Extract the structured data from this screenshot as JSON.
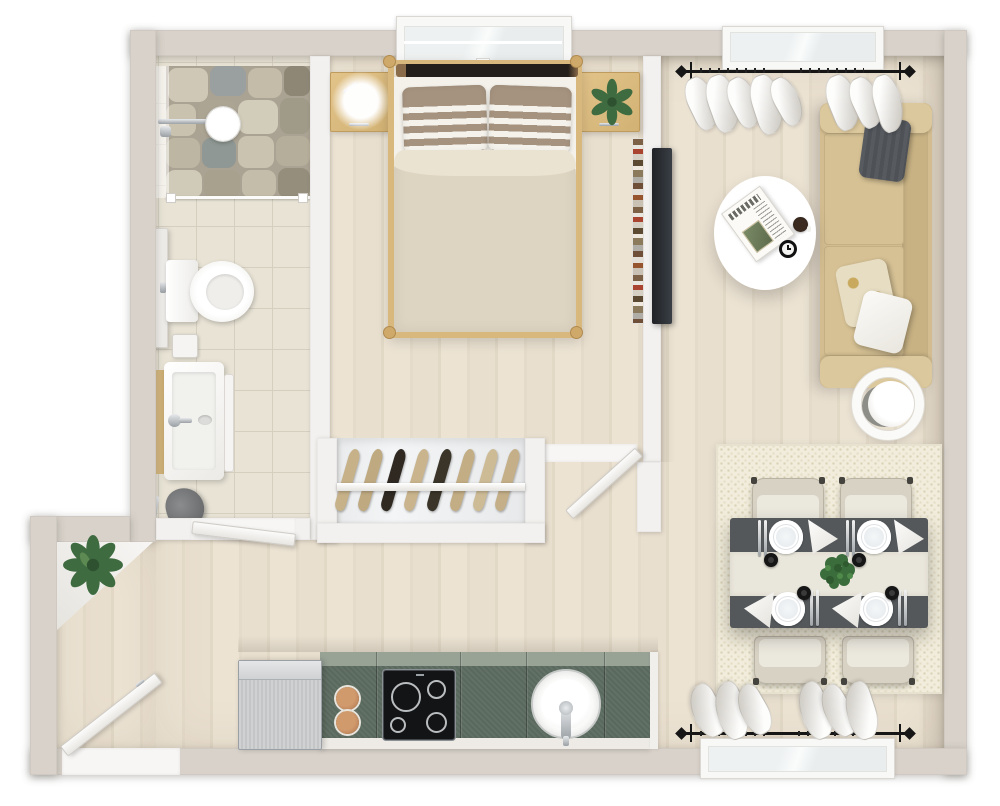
{
  "meta": {
    "scene": "3d-rendered-top-view-floor-plan-one-bedroom-apartment",
    "visible_text": "none"
  },
  "colors": {
    "wood": "#e9e0d0",
    "wall-ext": "#d8d2ca",
    "wall-int": "#f2f1ef",
    "tile": "#e8e3d5",
    "tile-line": "#d5cfc0",
    "counter-green": "#5a695e",
    "counter-back": "#98a295",
    "steel": "#c9cbcd",
    "table-dark": "#54585b",
    "runner": "#e9e6db",
    "sofa": "#d3bd90",
    "sofa-arm": "#dcc89d",
    "rug": "#f1ecdb",
    "rug-dot": "#d9d2b6",
    "duvet": "#ded4c2",
    "sheet": "#f4f1ea",
    "pillow-stripe": "#a5937f",
    "oak": "#dcbc80",
    "plant": "#3f6b40",
    "tv": "#2b2f34",
    "copper": "#c08b60",
    "chair": "#d8d2c4",
    "curtain-hi": "#fdfdfc",
    "curtain-lo": "#d5d2cc",
    "rod": "#161616"
  },
  "rooms": [
    {
      "name": "bathroom",
      "items": [
        "walk-in-shower",
        "stone-shower-floor",
        "rain-shower-head",
        "glass-partition",
        "tall-cabinet",
        "toilet",
        "flush-plate",
        "vanity-basin",
        "faucet",
        "towel-rail",
        "laundry-bag",
        "toilet-brush",
        "interior-door"
      ]
    },
    {
      "name": "bedroom",
      "items": [
        "window",
        "double-bed",
        "dark-headboard",
        "striped-pillow-x2",
        "duvet",
        "nightstand-x2",
        "glowing-table-lamp",
        "potted-plant",
        "wall-bookshelf",
        "open-closet",
        "hanging-garments-x8",
        "interior-door"
      ]
    },
    {
      "name": "living-room",
      "items": [
        "window",
        "curtain-rod",
        "sheer-curtains",
        "wall-tv",
        "sofa",
        "cushion-gray",
        "cushion-floral",
        "cushion-white",
        "oval-coffee-table",
        "newspaper",
        "coffee-cup",
        "table-clock",
        "ring-floor-lamp"
      ]
    },
    {
      "name": "dining-area",
      "items": [
        "area-rug",
        "dining-table",
        "table-runner",
        "herb-centerpiece",
        "plate-x4",
        "napkin-x4",
        "cutlery-x4",
        "espresso-cup-x4",
        "dining-chair-x4",
        "window",
        "curtain-rod",
        "sheer-curtains"
      ]
    },
    {
      "name": "kitchen",
      "items": [
        "refrigerator",
        "green-countertop",
        "copper-serving-board-x2",
        "cooktop-4-burner",
        "round-sink",
        "faucet"
      ]
    },
    {
      "name": "entry-hall",
      "items": [
        "corner-shelf",
        "potted-plant",
        "entry-door"
      ]
    }
  ],
  "counts": {
    "windows": 3,
    "doors": 3,
    "dining_chairs": 4,
    "place_settings": 4,
    "hanging_garments": 8,
    "cooktop_burners": 4,
    "bed_pillows": 2,
    "sofa_throw_pillows": 3
  }
}
